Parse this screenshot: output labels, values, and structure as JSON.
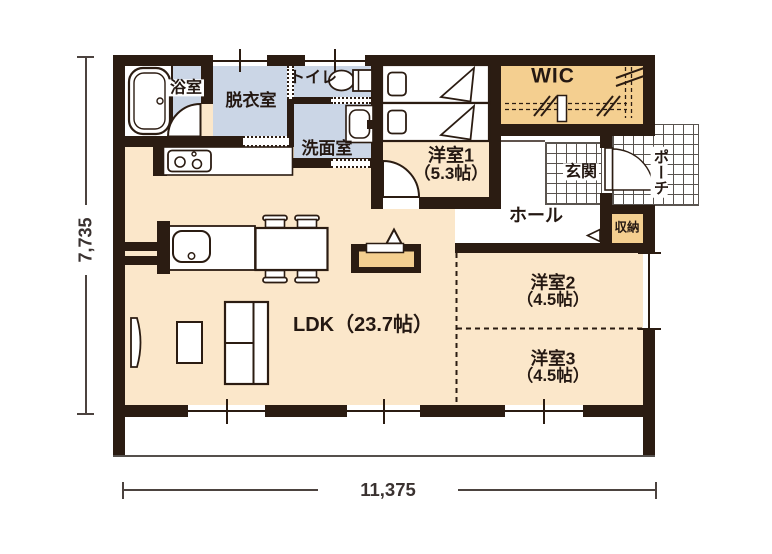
{
  "plan": {
    "title": "floor-plan",
    "rooms": {
      "bathroom": {
        "label": "浴室"
      },
      "dressing": {
        "label": "脱衣室"
      },
      "toilet": {
        "label": "トイレ"
      },
      "washroom": {
        "label": "洗面室"
      },
      "bedroom1": {
        "label": "洋室1",
        "size": "（5.3帖）"
      },
      "wic": {
        "label": "WIC"
      },
      "entrance": {
        "label": "玄関"
      },
      "porch": {
        "label": "ポーチ"
      },
      "hall": {
        "label": "ホール"
      },
      "storage": {
        "label": "収納"
      },
      "ldk": {
        "label": "LDK（23.7帖）"
      },
      "bedroom2": {
        "label": "洋室2",
        "size": "（4.5帖）"
      },
      "bedroom3": {
        "label": "洋室3",
        "size": "（4.5帖）"
      }
    },
    "dimensions": {
      "width": "11,375",
      "height": "7,735"
    },
    "colors": {
      "wall": "#2b1c12",
      "flooring": "#fbe7ca",
      "wet_area": "#cbd6e6",
      "closet": "#f4cf90"
    },
    "fixtures": [
      "bathtub",
      "toilet",
      "washbasin",
      "stove",
      "kitchen-sink",
      "dining-table",
      "chair",
      "sofa",
      "tv",
      "side-table",
      "counter-desk",
      "desk-lamp",
      "single-bed",
      "closet-rod",
      "door-swing",
      "step-arrow"
    ]
  }
}
